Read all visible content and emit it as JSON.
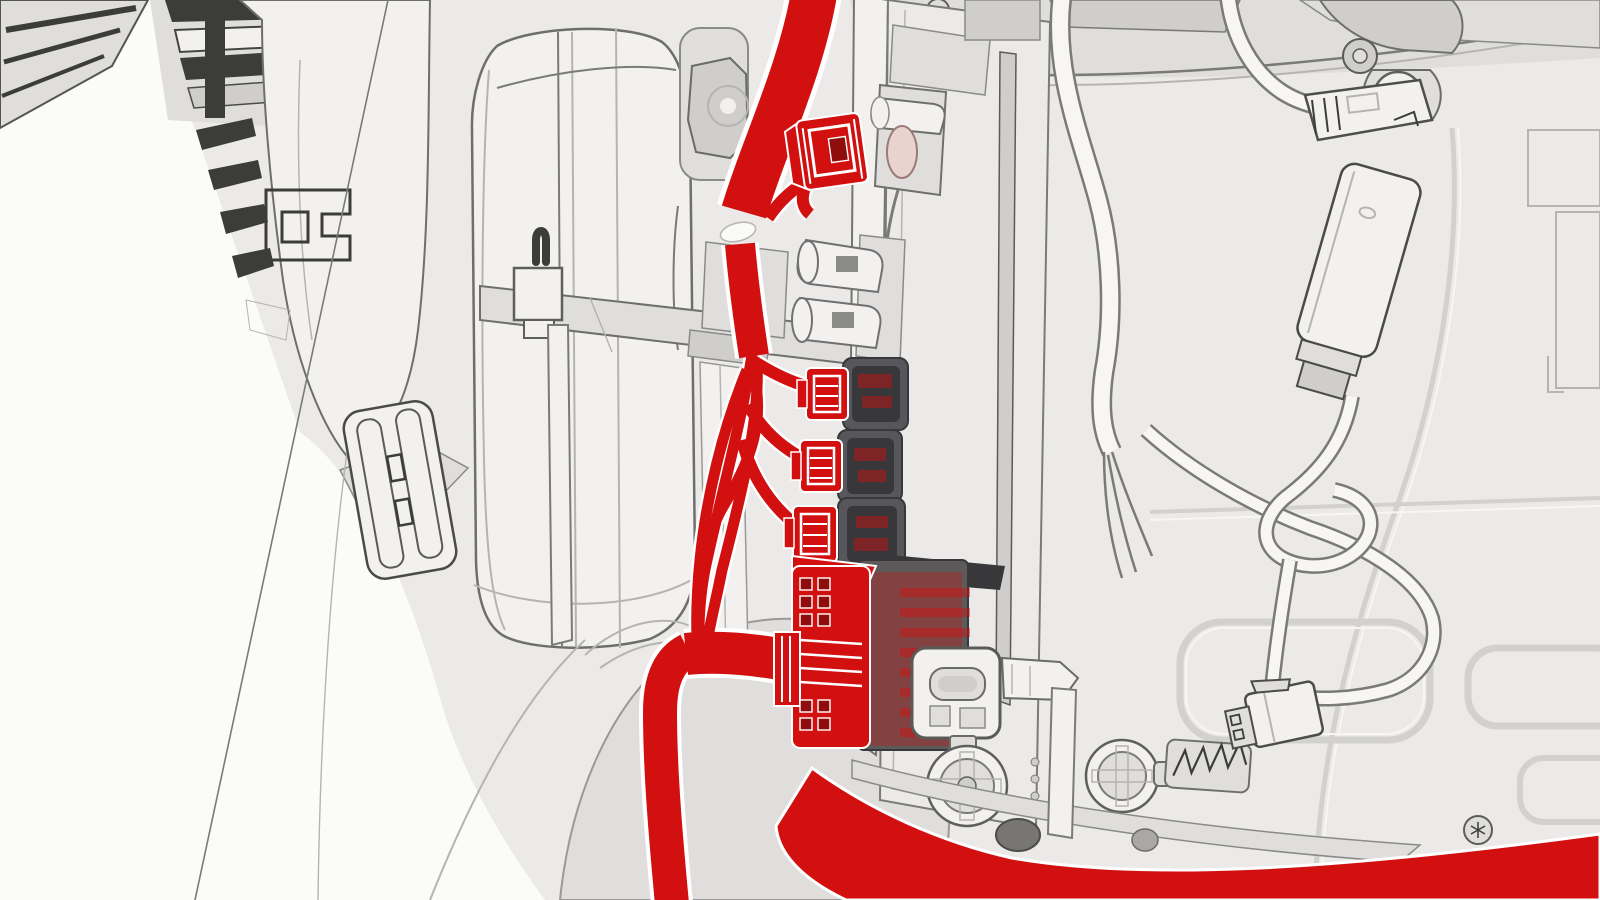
{
  "diagram": {
    "type": "technical-illustration",
    "subject": "vehicle-interior-wiring-harness-connectors-highlighted",
    "text_labels": [],
    "parts": [
      "red-wiring-harness",
      "harness-main-trunk",
      "harness-branch-wires",
      "coax-connector-plugged",
      "connector-a-plugged",
      "connector-b-plugged",
      "connector-c-plugged",
      "large-multipin-connector",
      "harness-bottom-sweep",
      "junction-box",
      "dark-socket-bank",
      "usb-c-receptacle",
      "round-socket-left",
      "round-socket-right",
      "blower-drum-housing",
      "left-bracket-assembly",
      "buckle-clip",
      "strap-beam",
      "antenna-module",
      "module-cable",
      "dangling-connector",
      "bracket-connector",
      "white-cable-cut-end",
      "body-panel",
      "hinge-bracket",
      "torx-screws"
    ]
  },
  "colors": {
    "page_bg": "#fbfbfa",
    "panel": "#ebeae8",
    "panel_light": "#f2f1ef",
    "panel_dark": "#dfdedc",
    "panel_dark2": "#cfcecc",
    "line": "#7a7a78",
    "line_dark": "#3c3c3a",
    "line_soft": "#b5b4b2",
    "emboss": "#d2d1cf",
    "emboss_hi": "#f7f6f5",
    "socket": "#57565a",
    "socket_dark": "#38383a",
    "module": "#5c5b59",
    "highlight_red": "#d21010",
    "red_dark": "#8f0d0d",
    "casing": "#ffffff"
  }
}
